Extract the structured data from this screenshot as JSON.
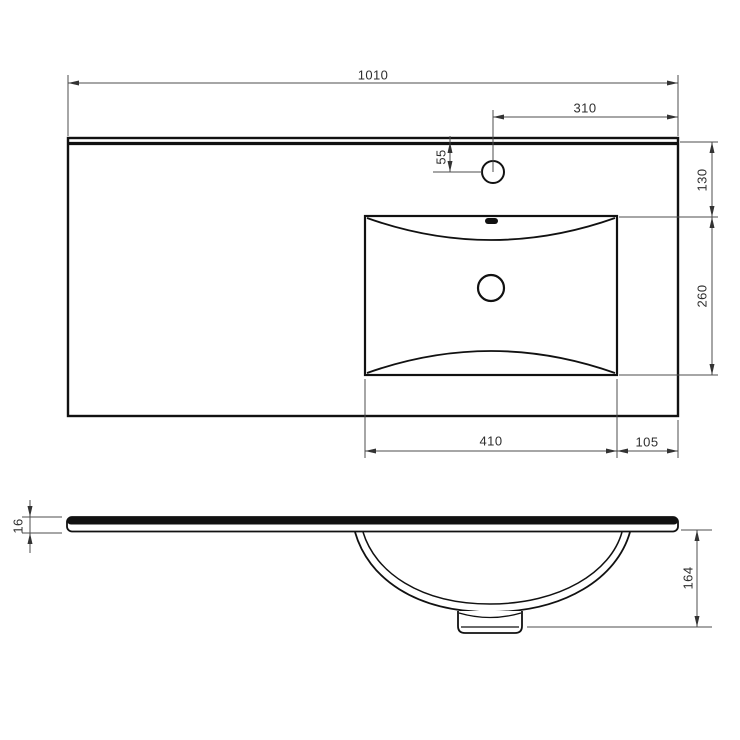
{
  "drawing_colors": {
    "outline": "#111111",
    "dimension_line": "#4d4d4d",
    "background": "#ffffff"
  },
  "views": {
    "top_view": {
      "dimensions": {
        "overall_width": "1010",
        "faucet_to_right_edge": "310",
        "faucet_offset_from_back": "55",
        "back_edge_to_basin": "130",
        "basin_front_back": "260",
        "basin_width": "410",
        "basin_to_right_edge": "105"
      }
    },
    "side_view": {
      "dimensions": {
        "slab_thickness": "16",
        "bowl_depth": "164"
      }
    }
  }
}
